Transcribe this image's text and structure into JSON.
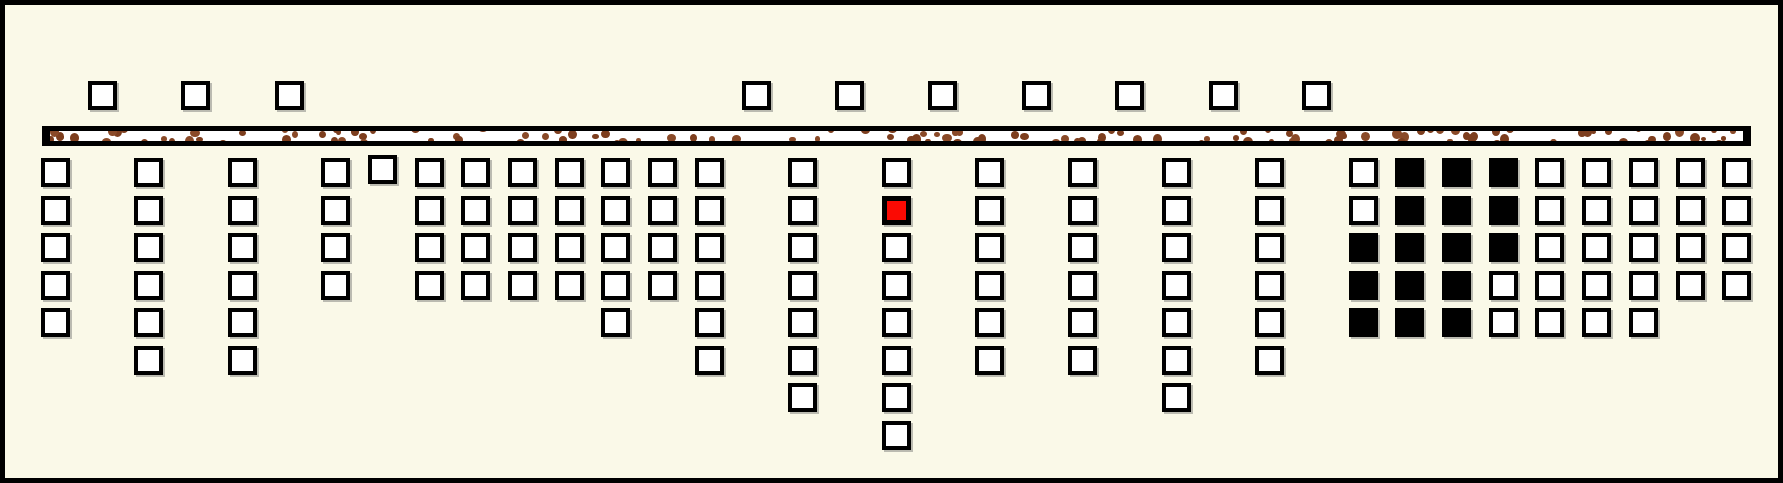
{
  "board": {
    "width": 1783,
    "height": 483,
    "background_color": "#faf9e8",
    "frame_color": "#000000",
    "frame_border_px": 5,
    "cell_style": {
      "size": 29,
      "border_px": 4,
      "white_fill": "#ffffff",
      "black_fill": "#000000",
      "red_fill": "#fb0a03",
      "border_color": "#000000",
      "shadow_color": "rgba(110,110,110,0.45)"
    },
    "grid": {
      "x_origin": 36,
      "col_pitch": 46.7,
      "row1_y": 153,
      "row_pitch": 37.5,
      "surface_row_y": 76
    },
    "surface_cells": {
      "count": 10,
      "col_indices": [
        1,
        3,
        5,
        15,
        17,
        19,
        21,
        23,
        25,
        27
      ]
    },
    "ground_bar": {
      "x": 37,
      "y": 121,
      "width": 1709,
      "height": 20,
      "edge_px": 5,
      "cap_px": 8,
      "fill": "#ffffff",
      "speckle_color": "#7d3e1e",
      "speckle_color_alt": "#8a4a28",
      "speckle_count": 130,
      "seed": 7
    },
    "columns": [
      {
        "i": 0,
        "rows": 5
      },
      {
        "i": 2,
        "rows": 6
      },
      {
        "i": 4,
        "rows": 6
      },
      {
        "i": 6,
        "rows": 4
      },
      {
        "i": 7,
        "rows": 1,
        "dy": -3
      },
      {
        "i": 8,
        "rows": 4
      },
      {
        "i": 9,
        "rows": 4
      },
      {
        "i": 10,
        "rows": 4
      },
      {
        "i": 11,
        "rows": 4
      },
      {
        "i": 12,
        "rows": 5
      },
      {
        "i": 13,
        "rows": 4
      },
      {
        "i": 14,
        "rows": 6
      },
      {
        "i": 16,
        "rows": 7
      },
      {
        "i": 18,
        "rows": 8,
        "red_rows": [
          2
        ]
      },
      {
        "i": 20,
        "rows": 6
      },
      {
        "i": 22,
        "rows": 6
      },
      {
        "i": 24,
        "rows": 7
      },
      {
        "i": 26,
        "rows": 6
      },
      {
        "i": 28,
        "rows": 5,
        "black_rows": [
          3,
          4,
          5
        ]
      },
      {
        "i": 29,
        "rows": 5,
        "black_rows": [
          1,
          2,
          3,
          4,
          5
        ]
      },
      {
        "i": 30,
        "rows": 5,
        "black_rows": [
          1,
          2,
          3,
          4,
          5
        ]
      },
      {
        "i": 31,
        "rows": 5,
        "black_rows": [
          1,
          2,
          3
        ]
      },
      {
        "i": 32,
        "rows": 5
      },
      {
        "i": 33,
        "rows": 5
      },
      {
        "i": 34,
        "rows": 5
      },
      {
        "i": 35,
        "rows": 4
      },
      {
        "i": 36,
        "rows": 4
      }
    ],
    "counts": {
      "below_ground_cells": 136,
      "black_cells": 16,
      "red_cells": 1
    }
  }
}
